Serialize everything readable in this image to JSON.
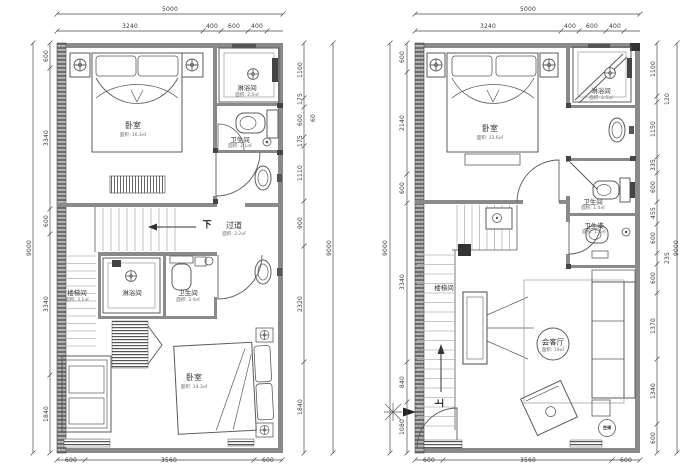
{
  "canvas": {
    "width": 694,
    "height": 473,
    "background": "#ffffff"
  },
  "palette": {
    "wall": "#8a8a8a",
    "wall_dark": "#4a4a4a",
    "line": "#5b5b5b",
    "light_line": "#b5b5b5",
    "dim_text": "#3a3a3a",
    "fixture": "#666666"
  },
  "plans": [
    {
      "name": "floor-plan-upper-unit",
      "dims": [
        {
          "t": "5000",
          "x": 170,
          "y": 10
        },
        {
          "t": "3240",
          "x": 130,
          "y": 27
        },
        {
          "t": "400",
          "x": 212,
          "y": 27
        },
        {
          "t": "600",
          "x": 234,
          "y": 27
        },
        {
          "t": "400",
          "x": 257,
          "y": 27
        },
        {
          "t": "9000",
          "x": 30,
          "y": 248,
          "v": true
        },
        {
          "t": "600",
          "x": 47,
          "y": 56,
          "v": true
        },
        {
          "t": "3340",
          "x": 47,
          "y": 138,
          "v": true
        },
        {
          "t": "600",
          "x": 47,
          "y": 221,
          "v": true
        },
        {
          "t": "3340",
          "x": 47,
          "y": 304,
          "v": true
        },
        {
          "t": "1840",
          "x": 47,
          "y": 414,
          "v": true
        },
        {
          "t": "1100",
          "x": 301,
          "y": 70,
          "v": true
        },
        {
          "t": "175",
          "x": 301,
          "y": 99,
          "v": true
        },
        {
          "t": "600",
          "x": 301,
          "y": 120,
          "v": true
        },
        {
          "t": "175",
          "x": 301,
          "y": 141,
          "v": true
        },
        {
          "t": "1110",
          "x": 301,
          "y": 173,
          "v": true
        },
        {
          "t": "900",
          "x": 301,
          "y": 223,
          "v": true
        },
        {
          "t": "2320",
          "x": 301,
          "y": 304,
          "v": true
        },
        {
          "t": "1840",
          "x": 301,
          "y": 407,
          "v": true
        },
        {
          "t": "60",
          "x": 314,
          "y": 118,
          "v": true
        },
        {
          "t": "9000",
          "x": 330,
          "y": 248,
          "v": true
        },
        {
          "t": "600",
          "x": 71,
          "y": 461
        },
        {
          "t": "3560",
          "x": 169,
          "y": 461
        },
        {
          "t": "600",
          "x": 268,
          "y": 461
        }
      ],
      "rooms": [
        {
          "t": "卧室",
          "x": 133,
          "y": 126,
          "fs": 8,
          "area": "面积: 16.3㎡",
          "ax": 133,
          "ay": 136
        },
        {
          "t": "淋浴间",
          "x": 247,
          "y": 88,
          "fs": 6.5,
          "area": "面积: 2.5㎡",
          "ax": 247,
          "ay": 96
        },
        {
          "t": "卫生间",
          "x": 240,
          "y": 140,
          "fs": 6.5,
          "area": "面积: 2.1㎡",
          "ax": 240,
          "ay": 147
        },
        {
          "t": "过道",
          "x": 234,
          "y": 226,
          "fs": 8,
          "area": "面积: 3.2㎡",
          "ax": 234,
          "ay": 235
        },
        {
          "t": "楼梯间",
          "x": 77,
          "y": 293,
          "fs": 6.5,
          "area": "面积: 3.1㎡",
          "ax": 77,
          "ay": 301
        },
        {
          "t": "淋浴间",
          "x": 132,
          "y": 293,
          "fs": 6.5
        },
        {
          "t": "卫生间",
          "x": 188,
          "y": 293,
          "fs": 6.5,
          "area": "面积: 3.4㎡",
          "ax": 188,
          "ay": 301
        },
        {
          "t": "卧室",
          "x": 194,
          "y": 378,
          "fs": 8,
          "area": "面积: 14.3㎡",
          "ax": 194,
          "ay": 388
        }
      ],
      "notes": [
        {
          "t": "下",
          "x": 207,
          "y": 226,
          "fs": 9,
          "name": "stairs-down-label"
        }
      ]
    },
    {
      "name": "floor-plan-lower-unit",
      "dims": [
        {
          "t": "5000",
          "x": 528,
          "y": 10
        },
        {
          "t": "3240",
          "x": 488,
          "y": 27
        },
        {
          "t": "400",
          "x": 570,
          "y": 27
        },
        {
          "t": "600",
          "x": 592,
          "y": 27
        },
        {
          "t": "400",
          "x": 615,
          "y": 27
        },
        {
          "t": "9000",
          "x": 386,
          "y": 248,
          "v": true
        },
        {
          "t": "600",
          "x": 403,
          "y": 57,
          "v": true
        },
        {
          "t": "2140",
          "x": 403,
          "y": 123,
          "v": true
        },
        {
          "t": "600",
          "x": 403,
          "y": 188,
          "v": true
        },
        {
          "t": "3340",
          "x": 403,
          "y": 282,
          "v": true
        },
        {
          "t": "840",
          "x": 403,
          "y": 382,
          "v": true
        },
        {
          "t": "1080",
          "x": 403,
          "y": 427,
          "v": true
        },
        {
          "t": "1100",
          "x": 654,
          "y": 69,
          "v": true
        },
        {
          "t": "120",
          "x": 668,
          "y": 99,
          "v": true
        },
        {
          "t": "1150",
          "x": 654,
          "y": 129,
          "v": true
        },
        {
          "t": "335",
          "x": 654,
          "y": 165,
          "v": true
        },
        {
          "t": "600",
          "x": 654,
          "y": 187,
          "v": true
        },
        {
          "t": "455",
          "x": 654,
          "y": 213,
          "v": true
        },
        {
          "t": "600",
          "x": 654,
          "y": 238,
          "v": true
        },
        {
          "t": "235",
          "x": 668,
          "y": 258,
          "v": true
        },
        {
          "t": "600",
          "x": 654,
          "y": 278,
          "v": true
        },
        {
          "t": "1370",
          "x": 654,
          "y": 326,
          "v": true
        },
        {
          "t": "1340",
          "x": 654,
          "y": 391,
          "v": true
        },
        {
          "t": "600",
          "x": 654,
          "y": 438,
          "v": true
        },
        {
          "t": "9000",
          "x": 677,
          "y": 248,
          "v": true
        },
        {
          "t": "600",
          "x": 429,
          "y": 461
        },
        {
          "t": "3560",
          "x": 528,
          "y": 461
        },
        {
          "t": "600",
          "x": 626,
          "y": 461
        }
      ],
      "rooms": [
        {
          "t": "卧室",
          "x": 490,
          "y": 129,
          "fs": 8,
          "area": "面积: 12.6㎡",
          "ax": 490,
          "ay": 139
        },
        {
          "t": "淋浴间",
          "x": 601,
          "y": 91,
          "fs": 6.5,
          "area": "面积: 2.5㎡",
          "ax": 601,
          "ay": 99
        },
        {
          "t": "卫生间",
          "x": 593,
          "y": 202,
          "fs": 6.5,
          "area": "面积: 1.4㎡",
          "ax": 593,
          "ay": 209
        },
        {
          "t": "卫生间",
          "x": 594,
          "y": 226,
          "fs": 6.5,
          "area": "面积: 1.2㎡",
          "ax": 594,
          "ay": 233
        },
        {
          "t": "楼梯间",
          "x": 444,
          "y": 288,
          "fs": 6.5
        },
        {
          "t": "会客厅",
          "x": 553,
          "y": 342,
          "fs": 7.5,
          "area": "面积: 19㎡",
          "ax": 553,
          "ay": 351
        }
      ],
      "notes": [
        {
          "t": "上",
          "x": 441,
          "y": 403,
          "fs": 9,
          "rot": -90,
          "name": "stairs-up-label"
        },
        {
          "t": "空调",
          "x": 607,
          "y": 428,
          "fs": 4,
          "name": "air-conditioner-label"
        }
      ]
    }
  ],
  "dim_lines": [
    {
      "o": "h",
      "pos": 14,
      "a": 57,
      "b": 283,
      "t": [
        57,
        283
      ]
    },
    {
      "o": "h",
      "pos": 31,
      "a": 57,
      "b": 283,
      "t": [
        57,
        203,
        221,
        248,
        267
      ]
    },
    {
      "o": "v",
      "pos": 33,
      "a": 43,
      "b": 453,
      "t": [
        43,
        453
      ]
    },
    {
      "o": "v",
      "pos": 50,
      "a": 43,
      "b": 453,
      "t": [
        43,
        68,
        209,
        234,
        375,
        453
      ]
    },
    {
      "o": "v",
      "pos": 304,
      "a": 43,
      "b": 453,
      "t": [
        43,
        98,
        107,
        137,
        146,
        201,
        246,
        362,
        453
      ]
    },
    {
      "o": "v",
      "pos": 333,
      "a": 43,
      "b": 453,
      "t": [
        43,
        453
      ]
    },
    {
      "o": "h",
      "pos": 460,
      "a": 57,
      "b": 283,
      "t": [
        57,
        85,
        254,
        282
      ]
    },
    {
      "o": "h",
      "pos": 14,
      "a": 415,
      "b": 640,
      "t": [
        415,
        640
      ]
    },
    {
      "o": "h",
      "pos": 31,
      "a": 415,
      "b": 640,
      "t": [
        415,
        561,
        579,
        606,
        624
      ]
    },
    {
      "o": "v",
      "pos": 390,
      "a": 43,
      "b": 453,
      "t": [
        43,
        453
      ]
    },
    {
      "o": "v",
      "pos": 407,
      "a": 43,
      "b": 453,
      "t": [
        43,
        72,
        174,
        203,
        362,
        402,
        453
      ]
    },
    {
      "o": "v",
      "pos": 657,
      "a": 43,
      "b": 453,
      "t": [
        43,
        96,
        102,
        157,
        173,
        202,
        224,
        253,
        264,
        293,
        359,
        424,
        453
      ]
    },
    {
      "o": "v",
      "pos": 677,
      "a": 43,
      "b": 453,
      "t": [
        43,
        453
      ]
    },
    {
      "o": "h",
      "pos": 460,
      "a": 415,
      "b": 640,
      "t": [
        415,
        443,
        612,
        640
      ]
    }
  ]
}
